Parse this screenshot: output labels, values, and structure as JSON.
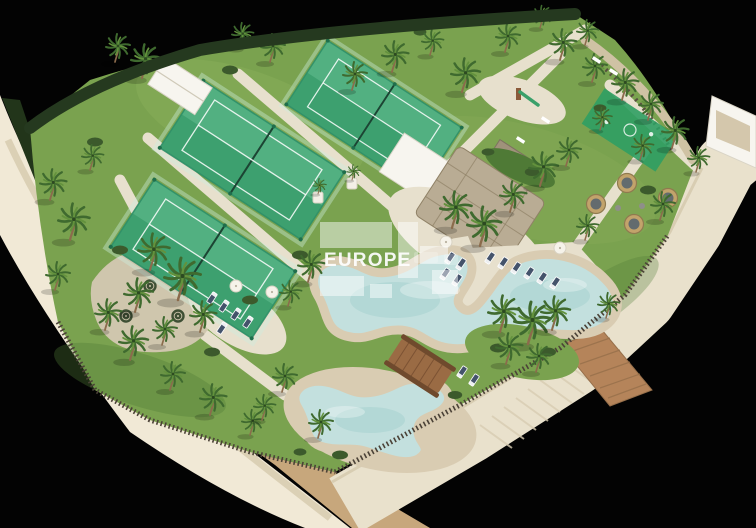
{
  "page": {
    "title": "Resort amenities aerial 3D render"
  },
  "watermark": {
    "brand": "EUROPE"
  },
  "colors": {
    "bg": "#030303",
    "band": "#f1e9d6",
    "bandShade": "#d6c9ac",
    "vegetation": "#22351a",
    "dirt": "#c7a77c",
    "road": "#e9e1cc",
    "roadEdge": "#d8cdb2",
    "boardwalk": "#b5845a",
    "plank": "#97halt"
  },
  "scene": {
    "description": "Aerial 3D render of a resort amenity plot isolated on a black background",
    "amenities": [
      "3 padel courts with glass fencing",
      "lagoon-style main swimming pool",
      "children's pool",
      "wooden bridge between pools",
      "thatched-roof pool bar (palapa)",
      "white pool-bar building",
      "equipment shed",
      "playground with slide",
      "mini sports soft-court",
      "sun loungers and parasols",
      "round wicker lounge pods",
      "spiral hedge gravel garden",
      "palm trees",
      "perimeter stake fence",
      "curved perimeter road and boardwalk"
    ],
    "counts": {
      "padel_courts": 3,
      "pools": 2,
      "lounge_pods": 4,
      "parasols": 4
    }
  }
}
